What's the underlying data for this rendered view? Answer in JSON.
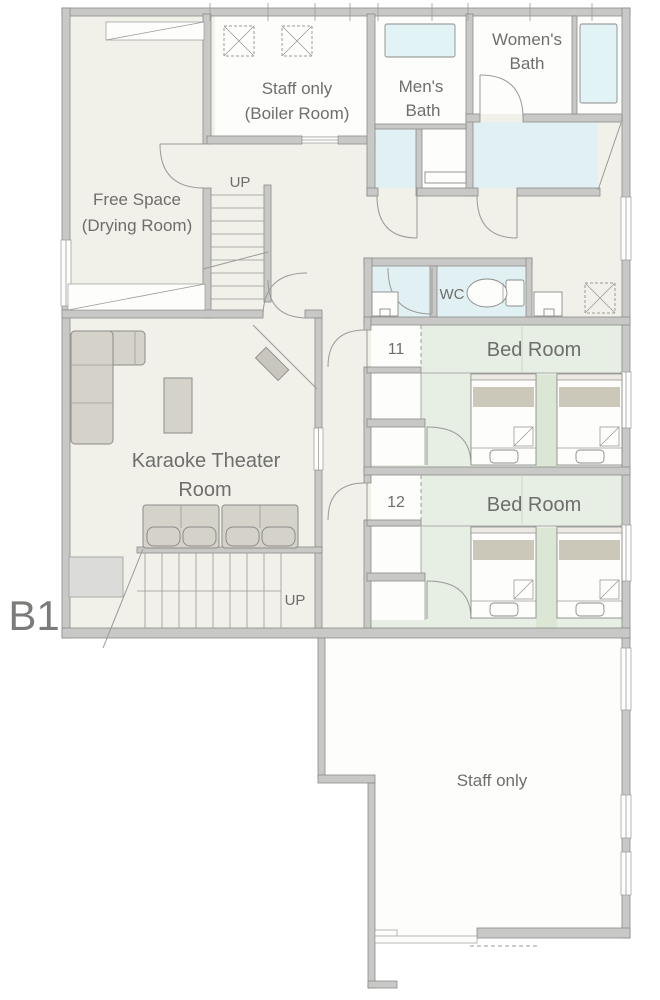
{
  "floor": {
    "label": "B1"
  },
  "rooms": {
    "free_space": {
      "name_line1": "Free Space",
      "name_line2": "(Drying Room)"
    },
    "boiler_room": {
      "name_line1": "Staff only",
      "name_line2": "(Boiler Room)"
    },
    "mens_bath": {
      "name_line1": "Men's",
      "name_line2": "Bath"
    },
    "womens_bath": {
      "name_line1": "Women's",
      "name_line2": "Bath"
    },
    "wc": {
      "name": "WC"
    },
    "bedroom_11": {
      "room_number": "11",
      "name": "Bed Room"
    },
    "bedroom_12": {
      "room_number": "12",
      "name": "Bed Room"
    },
    "karaoke": {
      "name_line1": "Karaoke Theater",
      "name_line2": "Room"
    },
    "staff_area": {
      "name": "Staff only"
    }
  },
  "stairs": {
    "hall_stairs_label": "UP",
    "karaoke_stairs_label": "UP"
  },
  "colors": {
    "wall": "#c8c8c6",
    "wall_outline": "#8b8b89",
    "floor_beige": "#f1f0e9",
    "floor_white": "#fdfdfc",
    "wet_area_blue": "#e1f1f3",
    "bedroom_green": "#e7eee3",
    "bedroom_mat_green": "#dbe6d5",
    "furniture_gray": "#d5d3c9",
    "text_gray": "#6e6e6c"
  }
}
